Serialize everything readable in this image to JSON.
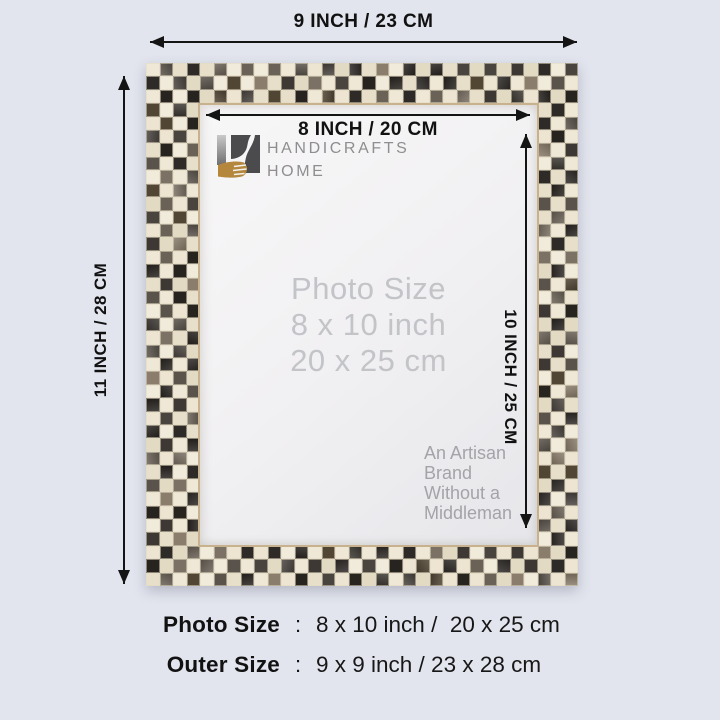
{
  "background": "#e2e5ee",
  "dimensions": {
    "outer_width": "9 INCH / 23 CM",
    "outer_height": "11 INCH / 28 CM",
    "inner_width": "8 INCH / 20 CM",
    "inner_height": "10 INCH / 25 CM"
  },
  "logo": {
    "line1": "HANDICRAFTS",
    "line2": "HOME",
    "colors": {
      "gold": "#b5873c",
      "charcoal": "#4b4a4c",
      "gray_text": "#8e8e90"
    }
  },
  "photo_area": {
    "title": "Photo Size",
    "size_inch": "8 x 10 inch",
    "size_cm": "20 x 25 cm",
    "artisan": [
      "An Artisan",
      "Brand",
      "Without a",
      "Middleman"
    ]
  },
  "summary": {
    "rows": [
      {
        "label": "Photo Size",
        "sep": ":",
        "value": "8 x 10 inch /  20 x 25 cm"
      },
      {
        "label": "Outer Size",
        "sep": ":",
        "value": "9 x 9 inch / 23 x 28 cm"
      }
    ]
  },
  "frame": {
    "grout": "#d9cfb6",
    "cream_tiles": [
      "#ede5d2",
      "#f1ebdc",
      "#e7dfca",
      "#efe8d6",
      "#e3dac4"
    ],
    "dark_tiles": [
      "#27231f",
      "#2e2a27",
      "#3d3833",
      "#4a443e",
      "#5a534b",
      "#6b6257",
      "#7b7164",
      "#514534",
      "#8a7d6b"
    ]
  }
}
